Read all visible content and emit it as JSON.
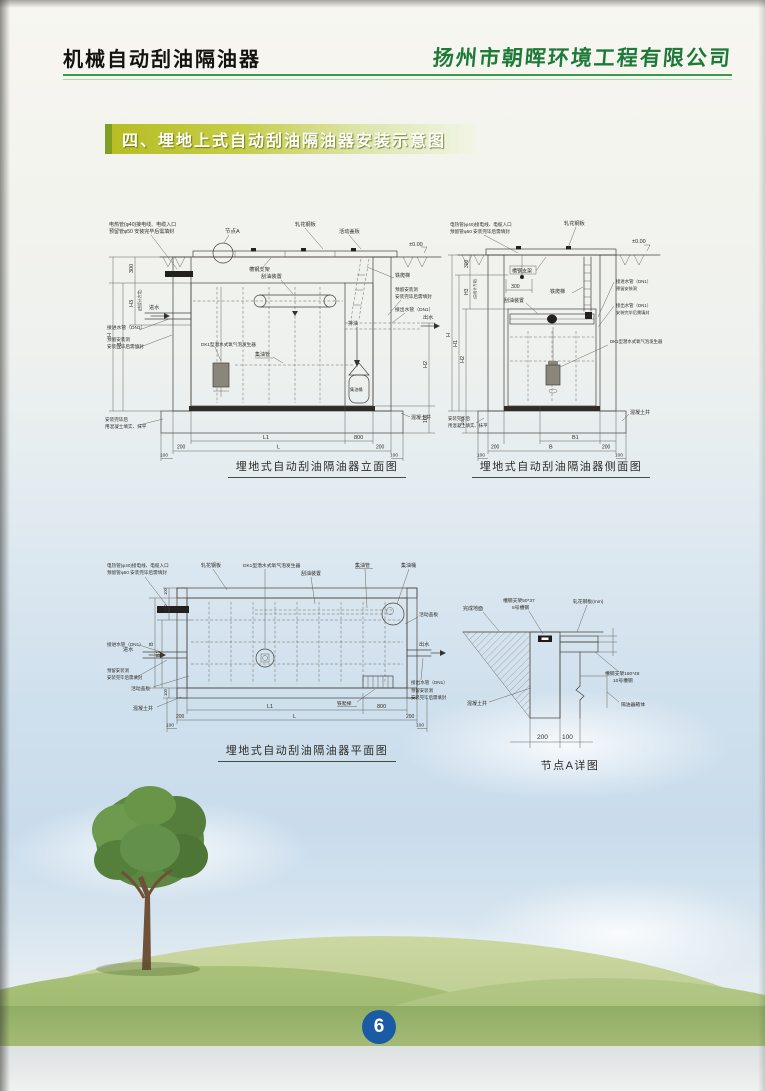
{
  "page": {
    "number": "6"
  },
  "header": {
    "title": "机械自动刮油隔油器",
    "company": "扬州市朝晖环境工程有限公司"
  },
  "section": {
    "title": "四、埋地上式自动刮油隔油器安装示意图"
  },
  "captions": {
    "elevation": "埋地式自动刮油隔油器立面图",
    "side": "埋地式自动刮油隔油器侧面图",
    "plan": "埋地式自动刮油隔油器平面图",
    "node": "节点A详图"
  },
  "labels": {
    "cable_note1": "电热管(φ40)接电线、电缆入口",
    "cable_note2": "预留管φ50 安装完毕后需填封",
    "node_a": "节点A",
    "checkered_plate": "轧花钢板",
    "movable_cover": "活动盖板",
    "level": "±0.00",
    "channel_support": "槽钢支架",
    "scraper": "刮油装置",
    "iron_ladder": "铁爬梯",
    "inlet": "进水",
    "outlet": "出水",
    "inlet_pipe": "接进水管（DN1）",
    "outlet_pipe": "接出水管（DN1）",
    "reserved_hole1": "预留安装洞",
    "reserved_hole2": "安装完毕后需填封",
    "aerator": "DK1型潜水式氧气泡发生器",
    "oil_pipe": "集油管",
    "oil_drain": "排油",
    "oil_barrel": "集油桶",
    "backfill1": "安装完毕后",
    "backfill2": "用混凝土填实、抹平",
    "concrete_well": "混凝土井"
  },
  "node_labels": {
    "finished_ground": "完成地面",
    "support_small1": "槽钢支架50*37",
    "support_small2": "5号槽钢",
    "plate_mm": "轧花钢板(mm)",
    "support_big1": "槽钢支架160*48",
    "support_big2": "10号槽钢",
    "separator_body": "隔油器箱体",
    "concrete_well": "混凝土井"
  },
  "dims": {
    "h": "H",
    "h1": "H1",
    "h2": "H2",
    "h3": "H3",
    "b": "B",
    "b1": "B1",
    "l": "L",
    "l1": "L1",
    "d100": "100",
    "d200": "200",
    "d300": "300",
    "d800": "800",
    "design_note": "(由设计方定)"
  }
}
